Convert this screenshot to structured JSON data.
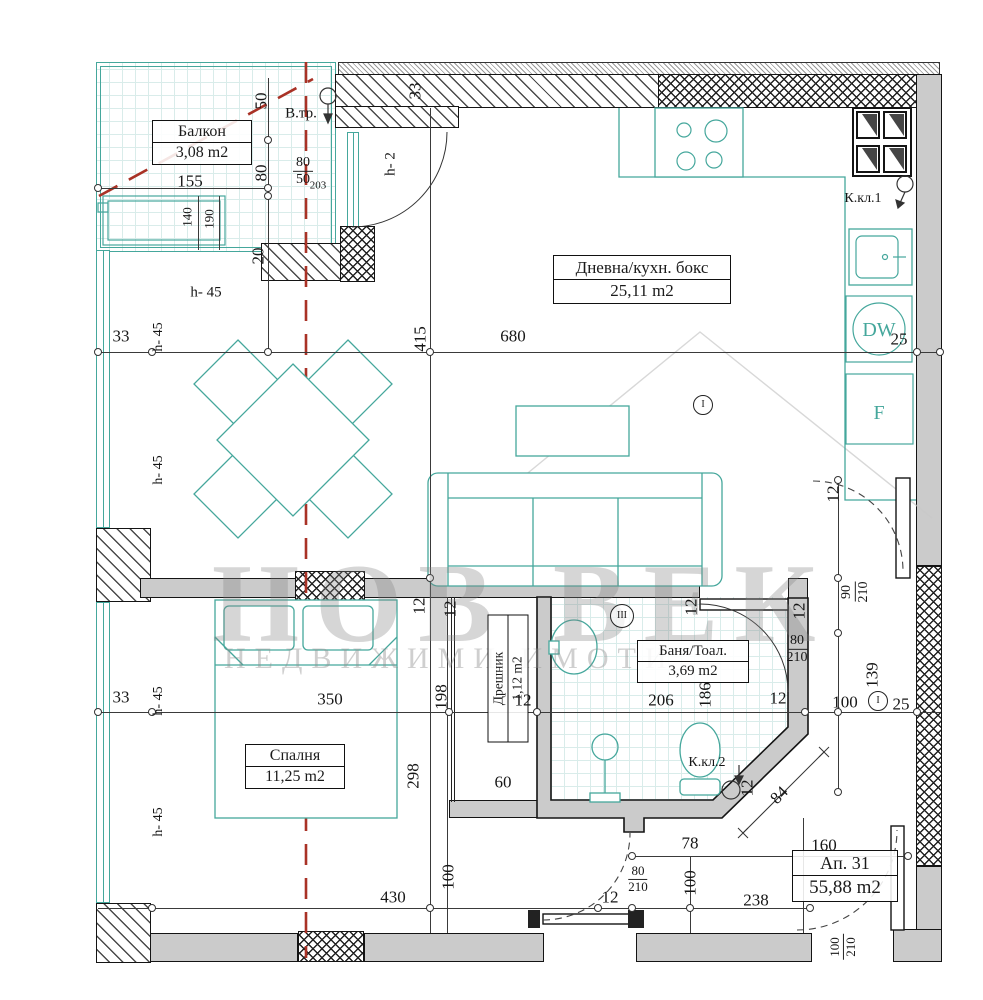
{
  "colors": {
    "furniture_teal": "#45a79c",
    "tile_grid": "#d9ecea",
    "axis_red_dashed": "#a93226",
    "wall_fill_gray": "#cbcbcb",
    "line_black": "#1b1b1b"
  },
  "rooms": {
    "balcony": {
      "name": "Балкон",
      "area": "3,08 m2"
    },
    "living": {
      "name": "Дневна/кухн. бокс",
      "area": "25,11 m2"
    },
    "bedroom": {
      "name": "Спалня",
      "area": "11,25 m2"
    },
    "closet": {
      "name": "Дрешник",
      "area": "1,12 m2"
    },
    "bath": {
      "name": "Баня/Тоал.",
      "area": "3,69 m2"
    }
  },
  "apartment": {
    "number": "Ап. 31",
    "area": "55,88 m2"
  },
  "kitchen": {
    "dishwasher": "DW",
    "fridge": "F"
  },
  "watermark": {
    "title": "НОВ ВЕК",
    "subtitle": "НЕДВИЖИМИ ИМОТИ"
  },
  "dimensions": [
    {
      "text": "155",
      "x": 190,
      "y": 181
    },
    {
      "text": "50",
      "x": 261,
      "y": 101,
      "rot": -90
    },
    {
      "text": "80",
      "x": 261,
      "y": 173,
      "rot": -90
    },
    {
      "text": "140",
      "x": 187,
      "y": 217,
      "rot": -90,
      "size": 13
    },
    {
      "text": "190",
      "x": 209,
      "y": 219,
      "rot": -90,
      "size": 13
    },
    {
      "text": "20",
      "x": 258,
      "y": 256,
      "rot": -90
    },
    {
      "kind": "frac",
      "top": "80",
      "bottom": "50",
      "x": 303,
      "y": 171
    },
    {
      "text": "203",
      "x": 318,
      "y": 186,
      "size": 11
    },
    {
      "text": "В.тр.",
      "x": 301,
      "y": 114,
      "size": 15
    },
    {
      "text": "h- 2",
      "x": 391,
      "y": 164,
      "rot": -90,
      "size": 15
    },
    {
      "text": "33",
      "x": 415,
      "y": 91,
      "rot": -90
    },
    {
      "text": "h- 45",
      "x": 206,
      "y": 293,
      "size": 15
    },
    {
      "text": "33",
      "x": 121,
      "y": 336
    },
    {
      "text": "h- 45",
      "x": 159,
      "y": 337,
      "rot": -90,
      "size": 14
    },
    {
      "text": "680",
      "x": 513,
      "y": 336
    },
    {
      "text": "415",
      "x": 420,
      "y": 339,
      "rot": -90
    },
    {
      "text": "25",
      "x": 899,
      "y": 339
    },
    {
      "text": "h- 45",
      "x": 159,
      "y": 470,
      "rot": -90,
      "size": 14
    },
    {
      "text": "К.кл.1",
      "x": 863,
      "y": 199,
      "size": 14
    },
    {
      "kind": "circ",
      "text": "I",
      "x": 703,
      "y": 405
    },
    {
      "kind": "frac",
      "top": "90",
      "bottom": "210",
      "x": 855,
      "y": 592,
      "rot": -90
    },
    {
      "text": "12",
      "x": 833,
      "y": 494,
      "rot": -90
    },
    {
      "text": "12",
      "x": 419,
      "y": 606,
      "rot": -90
    },
    {
      "text": "12",
      "x": 450,
      "y": 609,
      "rot": -90
    },
    {
      "text": "12",
      "x": 691,
      "y": 607,
      "rot": -90
    },
    {
      "text": "12",
      "x": 799,
      "y": 611,
      "rot": -90
    },
    {
      "kind": "circ",
      "text": "III",
      "x": 622,
      "y": 616,
      "r": 11
    },
    {
      "kind": "frac",
      "top": "80",
      "bottom": "210",
      "x": 797,
      "y": 649
    },
    {
      "text": "139",
      "x": 872,
      "y": 675,
      "rot": -90
    },
    {
      "text": "33",
      "x": 121,
      "y": 697
    },
    {
      "text": "h- 45",
      "x": 159,
      "y": 701,
      "rot": -90,
      "size": 14
    },
    {
      "text": "350",
      "x": 330,
      "y": 699
    },
    {
      "text": "198",
      "x": 441,
      "y": 697,
      "rot": -90
    },
    {
      "text": "298",
      "x": 413,
      "y": 776,
      "rot": -90
    },
    {
      "text": "12",
      "x": 523,
      "y": 700
    },
    {
      "text": "60",
      "x": 503,
      "y": 782
    },
    {
      "text": "206",
      "x": 661,
      "y": 700
    },
    {
      "text": "186",
      "x": 705,
      "y": 695,
      "rot": -90
    },
    {
      "text": "12",
      "x": 778,
      "y": 698
    },
    {
      "text": "100",
      "x": 845,
      "y": 702
    },
    {
      "kind": "circ",
      "text": "I",
      "x": 878,
      "y": 701
    },
    {
      "text": "25",
      "x": 901,
      "y": 704
    },
    {
      "text": "К.кл.2",
      "x": 707,
      "y": 763,
      "size": 14
    },
    {
      "text": "12",
      "x": 747,
      "y": 788,
      "rot": -90
    },
    {
      "text": "h- 45",
      "x": 159,
      "y": 822,
      "rot": -90,
      "size": 14
    },
    {
      "text": "84",
      "x": 779,
      "y": 795,
      "rot": -45
    },
    {
      "text": "78",
      "x": 690,
      "y": 843
    },
    {
      "text": "160",
      "x": 824,
      "y": 845
    },
    {
      "text": "100",
      "x": 690,
      "y": 883,
      "rot": -90
    },
    {
      "kind": "frac",
      "top": "80",
      "bottom": "210",
      "x": 638,
      "y": 879,
      "size": 13
    },
    {
      "text": "12",
      "x": 610,
      "y": 897
    },
    {
      "text": "238",
      "x": 756,
      "y": 900
    },
    {
      "text": "430",
      "x": 393,
      "y": 897
    },
    {
      "text": "100",
      "x": 448,
      "y": 877,
      "rot": -90
    },
    {
      "kind": "frac",
      "top": "100",
      "bottom": "210",
      "x": 843,
      "y": 947,
      "rot": -90,
      "size": 13
    }
  ]
}
